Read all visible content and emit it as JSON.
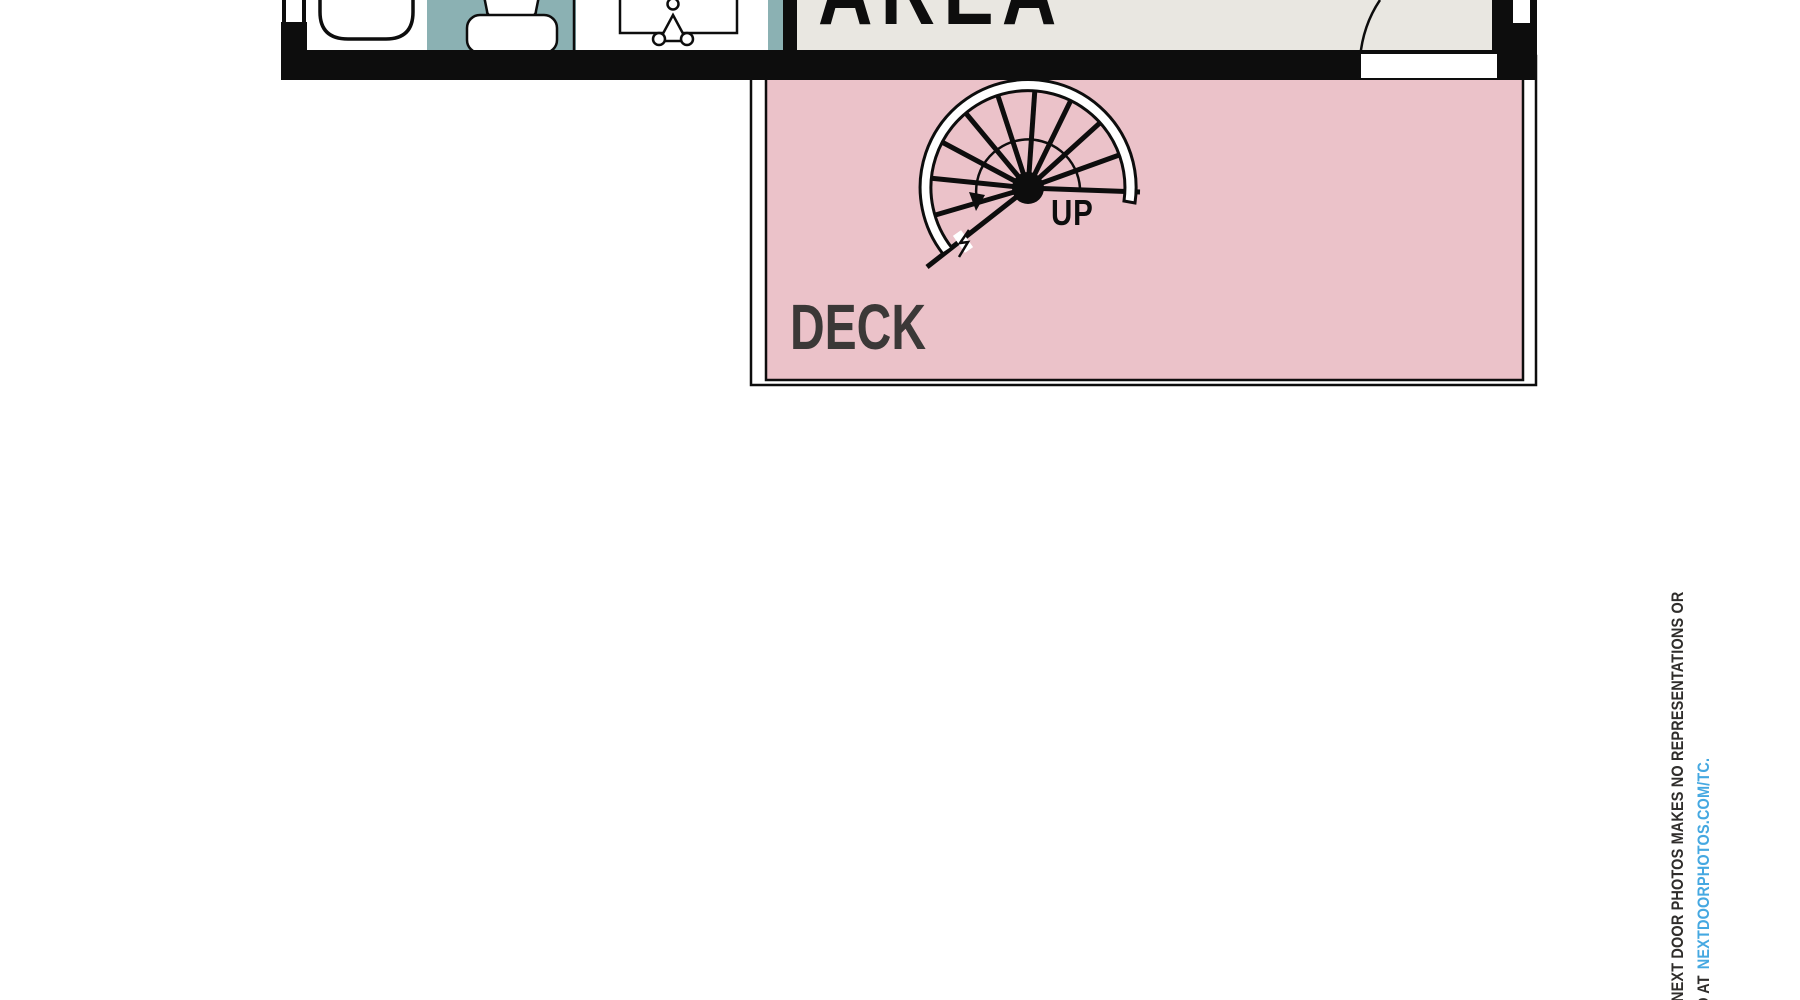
{
  "floor_plan": {
    "labels": {
      "area_room": "AREA",
      "deck_room": "DECK",
      "stairs_direction": "UP"
    },
    "symbols": {
      "stairs": "spiral-staircase",
      "fixtures": [
        "bathtub",
        "toilet",
        "sink"
      ],
      "door": "door-swing-arc"
    }
  },
  "disclaimer": {
    "line1": "NEXT DOOR PHOTOS MAKES NO REPRESENTATIONS OR",
    "line2_prefix": "D AT",
    "line2_link": "NEXTDOORPHOTOS.COM/TC."
  },
  "theme": {
    "wall-black": "#0d0d0d",
    "deck-pink": "#ebc2c9",
    "bath-teal": "#8bb1b3",
    "room-offwhite": "#e9e7e1",
    "deck-label": "#3b3837",
    "link-blue": "#45a8e1",
    "disclaimer-gray": "#2f2d2b"
  }
}
